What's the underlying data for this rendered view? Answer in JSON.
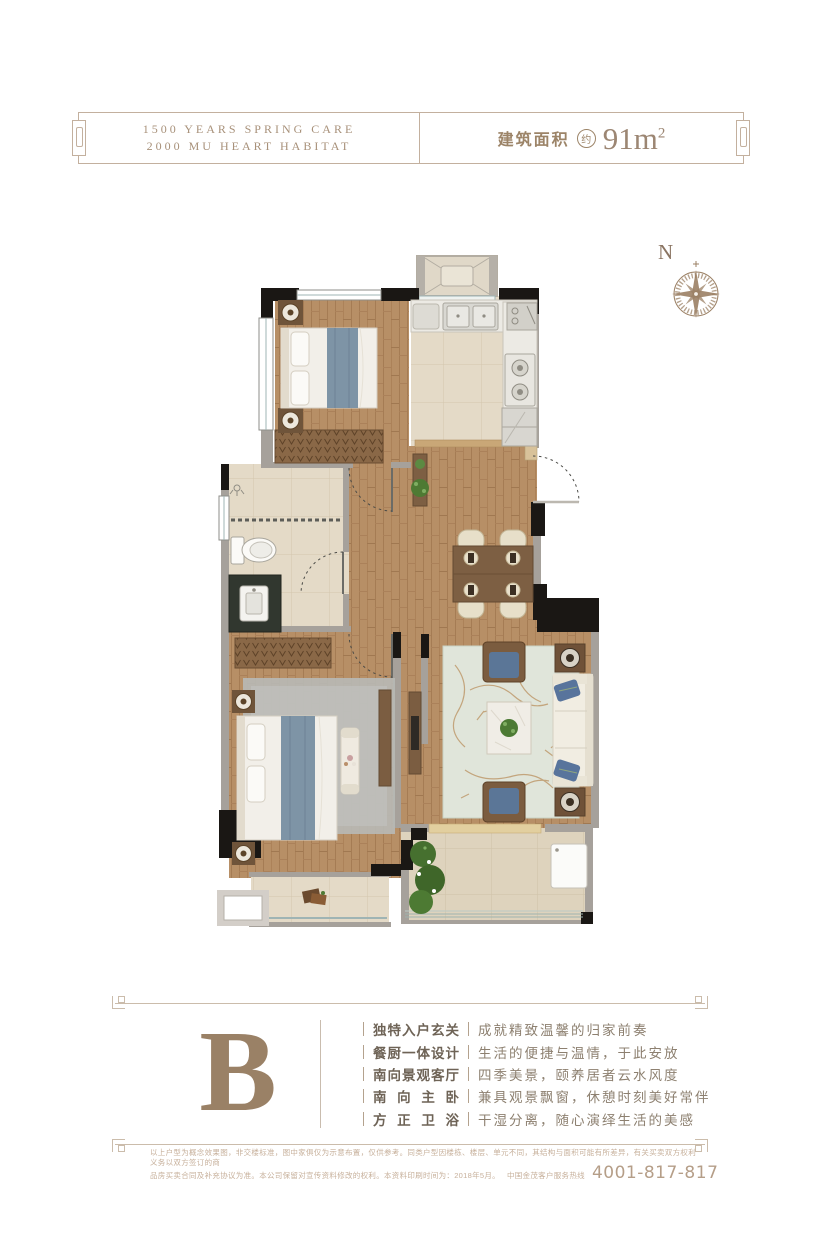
{
  "header": {
    "title_line1": "1500 YEARS SPRING CARE",
    "title_line2": "2000 MU HEART HABITAT",
    "area_label": "建筑面积",
    "area_circle": "约",
    "area_value": "91m",
    "area_exponent": "2"
  },
  "compass": {
    "north": "N"
  },
  "unit": {
    "letter": "B"
  },
  "features": [
    {
      "label": "独特入户玄关",
      "desc": "成就精致温馨的归家前奏"
    },
    {
      "label": "餐厨一体设计",
      "desc": "生活的便捷与温情，于此安放"
    },
    {
      "label": "南向景观客厅",
      "desc": "四季美景，颐养居者云水风度"
    },
    {
      "label": "南向主卧",
      "desc": "兼具观景飘窗，休憩时刻美好常伴"
    },
    {
      "label": "方正卫浴",
      "desc": "干湿分离，随心演绎生活的美感"
    }
  ],
  "footer": {
    "disclaimer_line1": "以上户型为概念效果图，非交楼标准，图中家俱仅为示意布置，仅供参考。同类户型因楼栋、楼层、单元不同，其结构与面积可能有所差异，有关买卖双方权利义务以双方签订的商",
    "disclaimer_line2": "品房买卖合同及补充协议为准。本公司保留对宣传资料修改的权利。本资料印刷时间为：2018年5月。",
    "hotline_label": "中国金茂客户服务热线",
    "hotline_number": "4001-817-817"
  },
  "colors": {
    "accent_taupe": "#9c8468",
    "wall_black": "#1a1714",
    "wood_floor": "#b78f66",
    "fabric_blue": "#7e94a6"
  }
}
